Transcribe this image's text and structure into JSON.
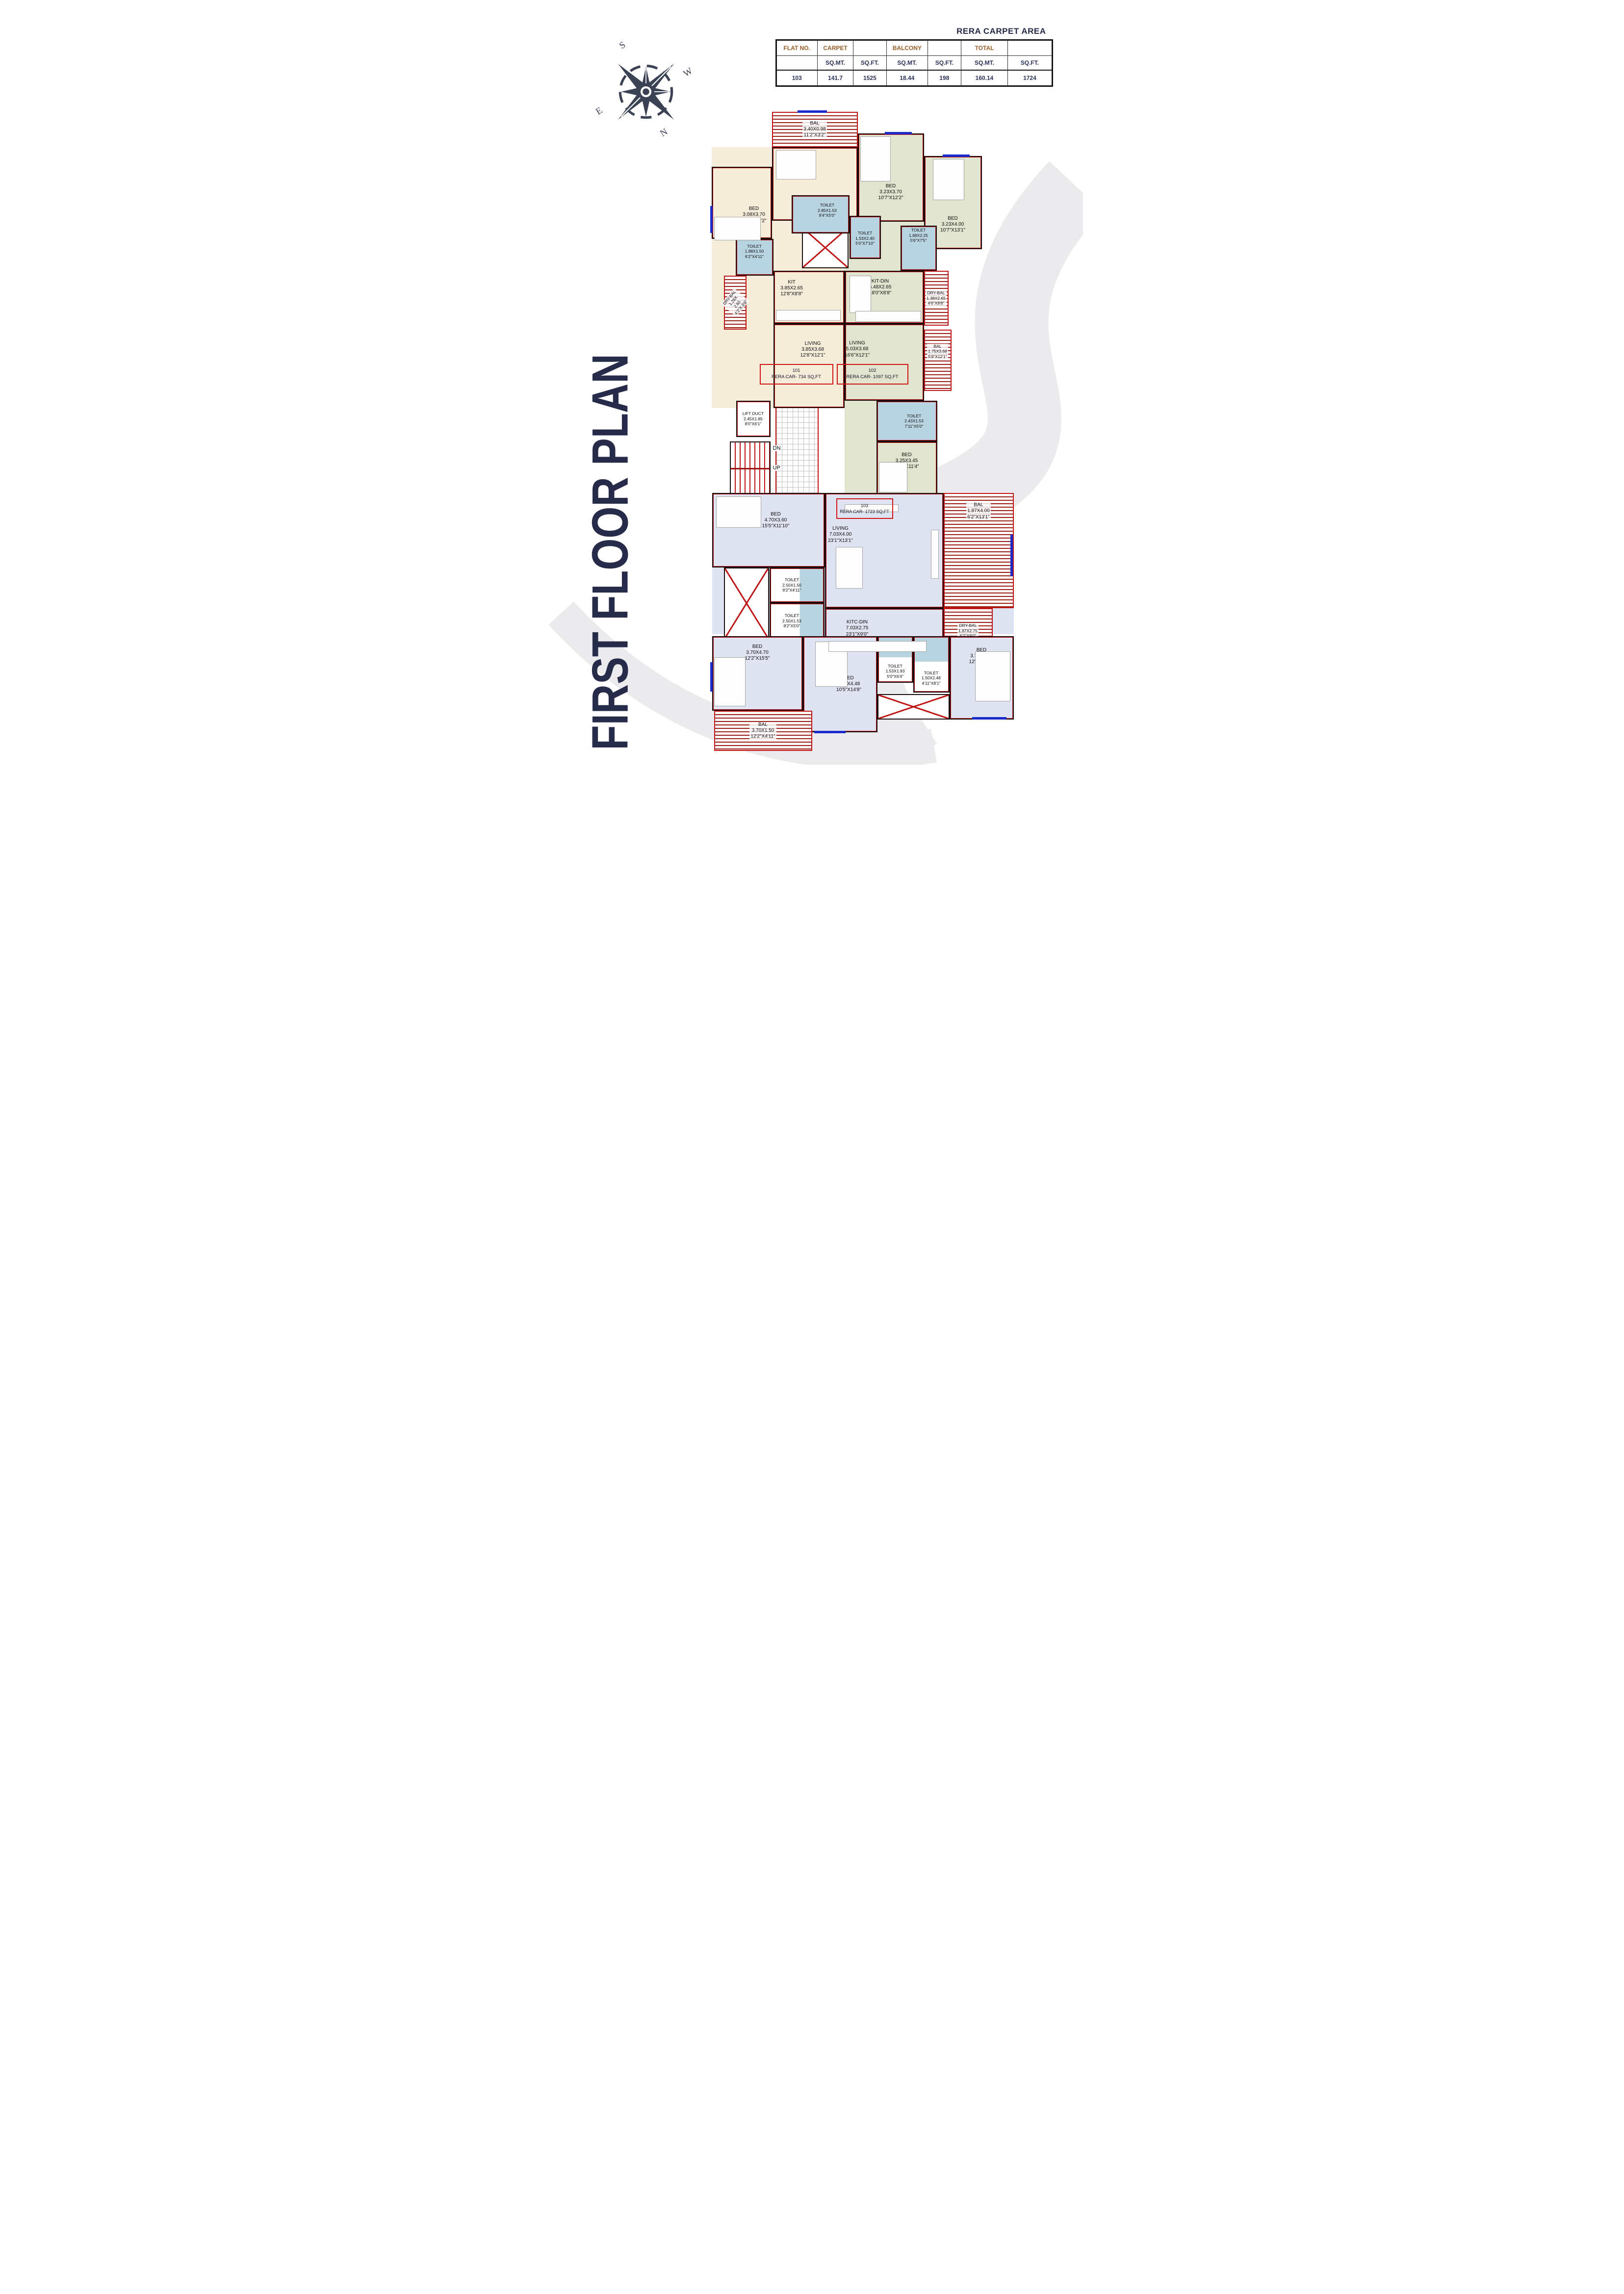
{
  "title": {
    "text": "FIRST FLOOR PLAN"
  },
  "compass": {
    "n": "N",
    "s": "S",
    "e": "E",
    "w": "W"
  },
  "stairs": {
    "dn": "DN",
    "up": "UP",
    "arrow": "←"
  },
  "table": {
    "title": "RERA CARPET AREA",
    "row1": [
      "FLAT NO.",
      "CARPET",
      "",
      "BALCONY",
      "",
      "TOTAL",
      ""
    ],
    "row2": [
      "",
      "SQ.MT.",
      "SQ.FT.",
      "SQ.MT.",
      "SQ.FT.",
      "SQ.MT.",
      "SQ.FT."
    ],
    "row3": [
      "103",
      "141.7",
      "1525",
      "18.44",
      "198",
      "160.14",
      "1724"
    ]
  },
  "flats": [
    {
      "no": "101",
      "rera": "RERA CAR- 734 SQ,FT"
    },
    {
      "no": "102",
      "rera": "RERA CAR- 1097 SQ,FT"
    },
    {
      "no": "103",
      "rera": "RERA CAR- 1723 SQ,FT"
    }
  ],
  "rooms": [
    {
      "name": "BAL",
      "m": "3.40X0.98",
      "ft": "11'2\"X3'2\""
    },
    {
      "name": "BED",
      "m": "3.40X3.15",
      "ft": "11'2\"X10'4\""
    },
    {
      "name": "BED",
      "m": "3.08X3.70",
      "ft": "10'1\"X12'2\""
    },
    {
      "name": "TOILET",
      "m": "1.88X1.50",
      "ft": "6'2\"X4'11\""
    },
    {
      "name": "DRY-BAL",
      "m": "1.28X 2.65",
      "ft": "4'2\"X 8'8\""
    },
    {
      "name": "KIT",
      "m": "3.85X2.65",
      "ft": "12'8\"X8'8\""
    },
    {
      "name": "LIVING",
      "m": "3.85X3.68",
      "ft": "12'8\"X12'1\""
    },
    {
      "name": "BED",
      "m": "3.23X3.70",
      "ft": "10'7\"X12'2\""
    },
    {
      "name": "BED",
      "m": "3.23X4.00",
      "ft": "10'7\"X13'1\""
    },
    {
      "name": "TOILET",
      "m": "2.85X1.53",
      "ft": "9'4\"X5'0\""
    },
    {
      "name": "TOILET",
      "m": "1.53X2.40",
      "ft": "5'0\"X7'10\""
    },
    {
      "name": "TOILET",
      "m": "1.68X2.25",
      "ft": "5'6\"X7'5\""
    },
    {
      "name": "DRY-BAL",
      "m": "1.38X2.65",
      "ft": "4'6\"X8'8\""
    },
    {
      "name": "KIT-DIN",
      "m": "5.48X2.65",
      "ft": "18'0\"X8'8\""
    },
    {
      "name": "LIVING",
      "m": "5.03X3.68",
      "ft": "16'6\"X12'1\""
    },
    {
      "name": "BAL",
      "m": "1.75X3.68",
      "ft": "5'9\"X12'1\""
    },
    {
      "name": "TOILET",
      "m": "2.43X1.53",
      "ft": "7'11\"X5'0\""
    },
    {
      "name": "BED",
      "m": "3.25X3.45",
      "ft": "10'8\"X11'4\""
    },
    {
      "name": "LIFT DUCT",
      "m": "2.45X1.85",
      "ft": "8'0\"X6'1\""
    },
    {
      "name": "BED",
      "m": "4.70X3.60",
      "ft": "15'5\"X11'10\""
    },
    {
      "name": "LIVING",
      "m": "7.03X4.00",
      "ft": "23'1\"X13'1\""
    },
    {
      "name": "BAL",
      "m": "1.87X4.00",
      "ft": "6'2\"X13'1\""
    },
    {
      "name": "TOILET",
      "m": "2.50X1.50",
      "ft": "8'2\"X4'11\""
    },
    {
      "name": "TOILET",
      "m": "2.50X1.53",
      "ft": "8'2\"X5'0\""
    },
    {
      "name": "KITC-DIN",
      "m": "7.03X2.75",
      "ft": "23'1\"X9'0\""
    },
    {
      "name": "DRY-BAL",
      "m": "1.87X2.75",
      "ft": "6'2\"X9'0\""
    },
    {
      "name": "BED",
      "m": "3.70X4.70",
      "ft": "12'2\"X15'5\""
    },
    {
      "name": "BED",
      "m": "3.18X4.48",
      "ft": "10'5\"X14'8\""
    },
    {
      "name": "TOILET",
      "m": "1.53X1.93",
      "ft": "5'0\"X6'4\""
    },
    {
      "name": "TOILET",
      "m": "1.50X2.48",
      "ft": "4'11\"X8'1\""
    },
    {
      "name": "BED",
      "m": "3.70X4.45",
      "ft": "12'2\"X14'7\""
    },
    {
      "name": "BAL",
      "m": "3.70X1.50",
      "ft": "12'2\"X4'11\""
    }
  ],
  "meta": {
    "colors": {
      "flat_101": "#f6ecda",
      "flat_102": "#e1e5cf",
      "flat_103": "#e0e3f2",
      "toilet": "#b9d4e1",
      "wall": "#1c0e0e",
      "accent_red": "#c11414",
      "hatch_red": "#9e1b17",
      "navy_text": "#262b49",
      "table_header_brown": "#9a5d28",
      "window_blue": "#1b2bc9",
      "watermark": "#ebebee"
    }
  }
}
